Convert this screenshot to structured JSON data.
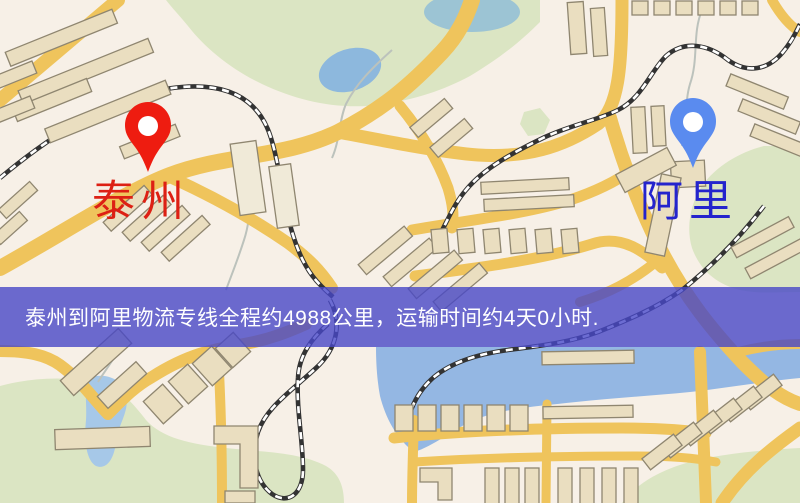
{
  "markers": {
    "origin": {
      "label": "泰州",
      "label_color": "#dd2014",
      "pin_color": "#ee1c10",
      "pin_icon": "map-pin"
    },
    "destination": {
      "label": "阿里",
      "label_color": "#2424cd",
      "pin_color": "#5a8bef",
      "pin_icon": "map-pin"
    }
  },
  "banner": {
    "text": "泰州到阿里物流专线全程约4988公里，运输时间约4天0小时.",
    "text_color": "#ffffff",
    "background": "rgba(71,71,199,0.8)",
    "origin": "泰州",
    "destination": "阿里",
    "distance": "约4988公里",
    "duration": "约4天0小时"
  },
  "map": {
    "colors": {
      "base": "#f7f0e7",
      "road": "#efc45c",
      "park": "#dbe5c3",
      "water": "#94b7e3",
      "building": "#eadec0",
      "building_outline": "#8f8670",
      "railway": "#333333"
    }
  }
}
